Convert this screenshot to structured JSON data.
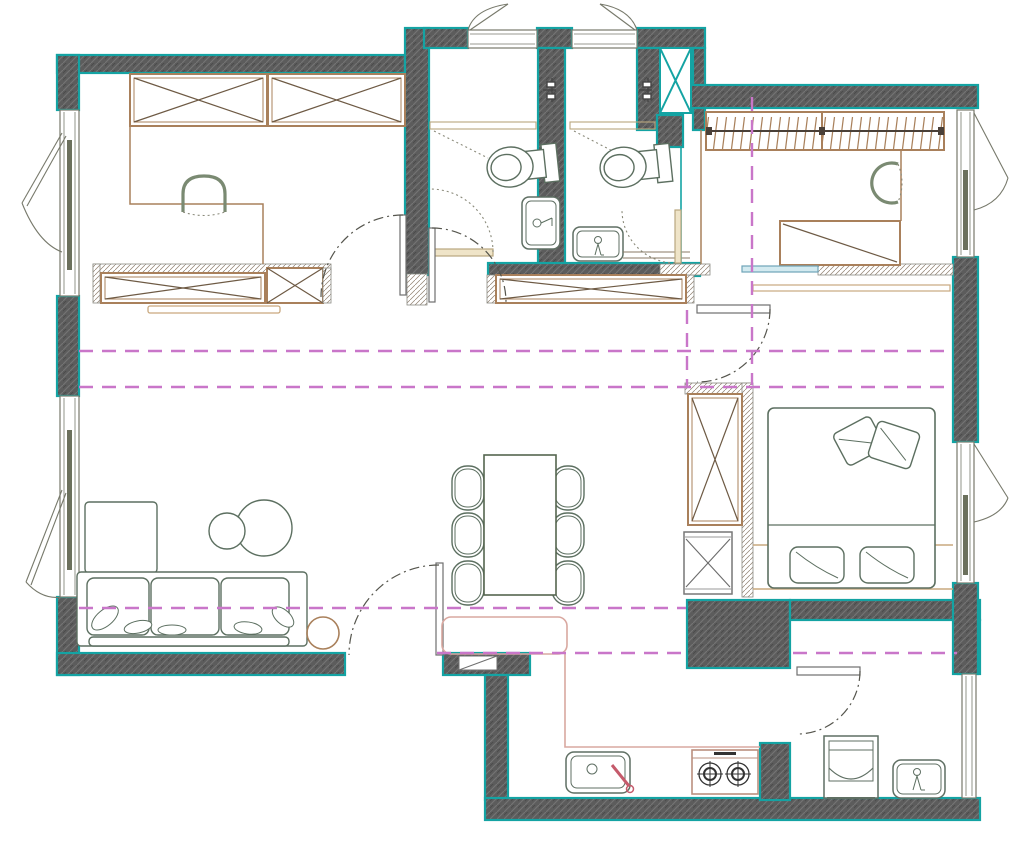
{
  "meta": {
    "title": "Apartment renovation floor plan drawing",
    "canvas": {
      "width": 1024,
      "height": 843
    }
  },
  "colors": {
    "teal": "#14A3A3",
    "wall-fill": "#5C5C5C",
    "wall-hatch": "#747474",
    "wall-hatch-dark": "#4A4A4A",
    "light-hatch": "#8F7F6F",
    "magenta": "#C976C9",
    "sage": "#5C6F60",
    "sage-soft": "#7A8A72",
    "tan": "#A9805B",
    "tan-dark": "#6E5A44",
    "tan-light": "#C9A87E",
    "cream": "#EFE4C8",
    "cream-edge": "#B9A77E",
    "pink": "#D9A8A0",
    "red": "#C55A6B",
    "blue": "#6FA3B8",
    "blue-light": "#D3EAF0",
    "gray-line": "#77796B",
    "door-arc": "#55554D",
    "appl": "#5F6F63",
    "stove": "#BA8F7E"
  },
  "legend": {
    "exterior_wall": "dark hatched wall with teal edge",
    "partition": "light diagonal-hatch partition",
    "planning_line": "magenta dashed line",
    "door_swing": "dash-dot arc"
  },
  "rooms": [
    {
      "name": "master-suite",
      "fixtures": [
        "wardrobe-x-cabinets",
        "desk",
        "desk-chair",
        "tv-console",
        "tv-shelf",
        "casement-windows"
      ]
    },
    {
      "name": "bathroom-1",
      "fixtures": [
        "shower-mixer",
        "shower-screen",
        "toilet",
        "washbasin",
        "door",
        "top-window"
      ]
    },
    {
      "name": "bathroom-2",
      "fixtures": [
        "shower-mixer",
        "shower-screen",
        "toilet",
        "vanity-basin",
        "counter",
        "door",
        "top-window",
        "duct-shaft"
      ]
    },
    {
      "name": "walk-in-closet",
      "fixtures": [
        "hanging-wardrobe",
        "desk",
        "chair",
        "dresser",
        "sliding-door",
        "window"
      ]
    },
    {
      "name": "bedroom",
      "fixtures": [
        "double-bed",
        "pillows",
        "throw-cushions",
        "wardrobe-column",
        "low-cabinet",
        "window",
        "door"
      ]
    },
    {
      "name": "living-room",
      "fixtures": [
        "corner-sofa",
        "sofa-pillows",
        "coffee-table-pair",
        "side-table",
        "window",
        "terrace-door"
      ]
    },
    {
      "name": "dining-area",
      "fixtures": [
        "dining-table",
        "six-chairs",
        "rug"
      ]
    },
    {
      "name": "kitchen",
      "fixtures": [
        "l-shaped-counter",
        "sink",
        "faucet",
        "two-burner-cooktop",
        "wall-niche"
      ]
    },
    {
      "name": "laundry-room",
      "fixtures": [
        "washing-machine",
        "utility-sink",
        "door",
        "window"
      ]
    },
    {
      "name": "hallway",
      "fixtures": [
        "storage-x-cabinet",
        "double-swing-door"
      ]
    }
  ],
  "counts": {
    "windows": 7,
    "doors": 8,
    "chairs": 6,
    "toilets": 2,
    "sinks": 4,
    "burners": 2
  }
}
